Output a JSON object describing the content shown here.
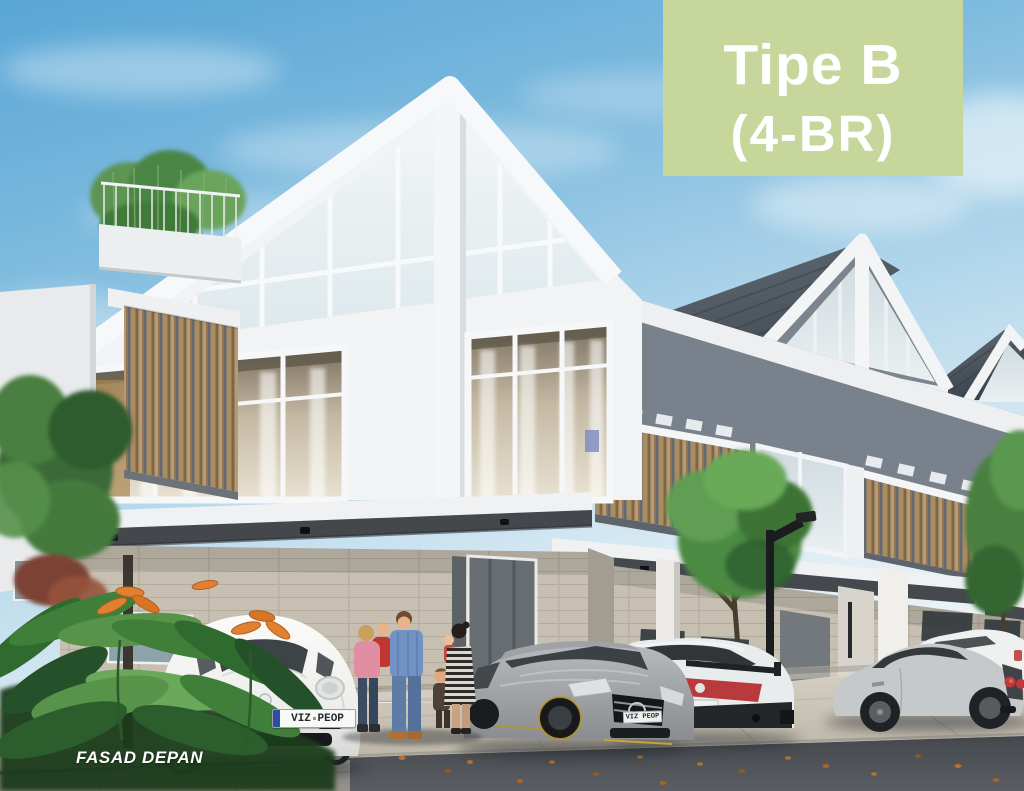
{
  "badge": {
    "title": "Tipe B",
    "subtitle": "(4-BR)",
    "background_color": "#c7d69b",
    "text_color": "#ffffff"
  },
  "caption": {
    "text": "FASAD DEPAN",
    "color": "#ffffff"
  },
  "license_plates": {
    "front_car": "VIZ PEOP",
    "gray_car": "VIZ PEOP"
  },
  "scene": {
    "elements": [
      "gabled glass facade",
      "rooftop garden",
      "wood slat balconies",
      "carport canopies",
      "parked cars",
      "family group",
      "tropical plants",
      "street lamp",
      "road"
    ],
    "palette": {
      "sky_top": "#58a6d5",
      "sky_horizon": "#ecf3f6",
      "badge_green": "#c7d69b",
      "roof_slate": "#4c555f",
      "facade_white": "#f3f4f5",
      "recessed_gray": "#79828c",
      "wood_slat": "#a3875e",
      "stone_wall": "#c6bfb2",
      "pavement": "#cfc8ba",
      "road": "#4a4e53",
      "foliage_green": "#4c8a43",
      "flower_orange": "#e08030"
    }
  }
}
